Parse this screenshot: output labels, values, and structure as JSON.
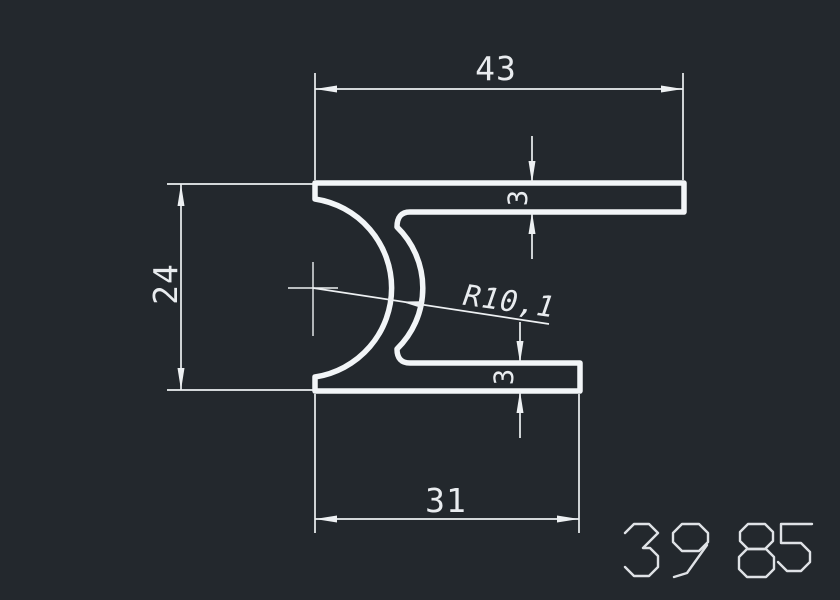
{
  "drawing": {
    "number": "3985",
    "number_label": "drawing number 3985",
    "dimensions": {
      "top_width": "43",
      "left_height": "24",
      "bottom_width": "31",
      "top_flange_thickness": "3",
      "bottom_flange_thickness": "3",
      "inner_radius": "R10,1"
    },
    "colors": {
      "background": "#23282d",
      "profile_line": "#f2f5f7",
      "dimension_line": "#edf0f2",
      "dimension_text": "#e9ecef",
      "number_text": "#dfe2e6"
    }
  }
}
